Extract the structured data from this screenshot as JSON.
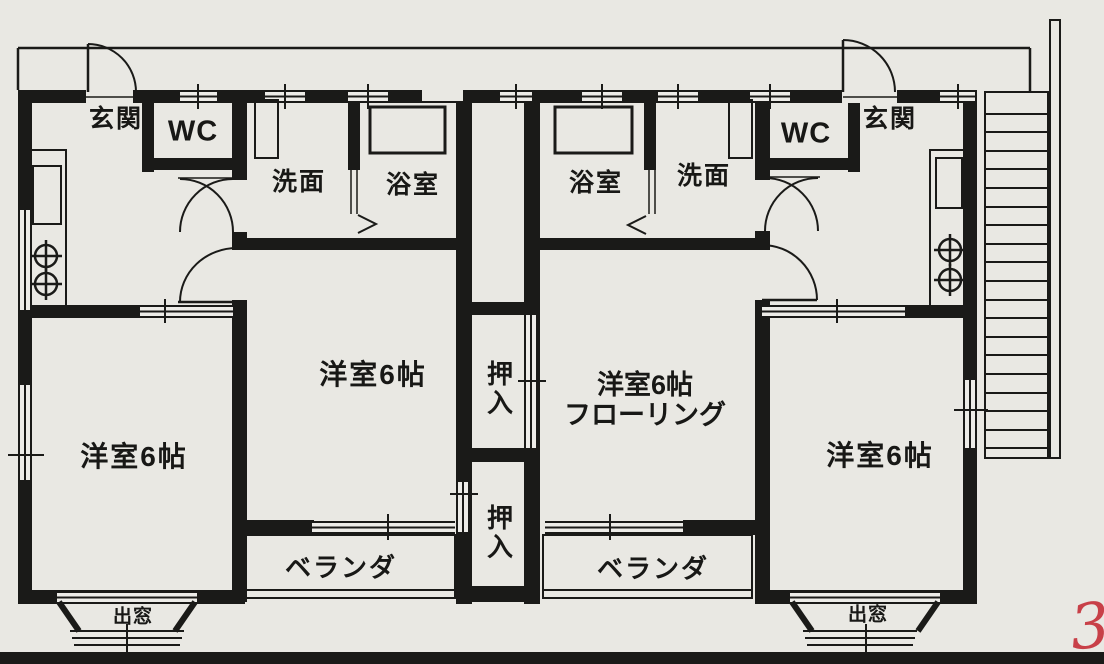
{
  "labels": {
    "genkan": "玄関",
    "wc": "WC",
    "senmen": "洗面",
    "yokushitsu": "浴室",
    "yoshitsu": "洋室6帖",
    "flooring": "フローリング",
    "oshiire": "押入",
    "veranda": "ベランダ",
    "demado": "出窓",
    "side_arrow": "<",
    "side_text": "入印保印",
    "red_mark": "3"
  },
  "colors": {
    "wall": "#1a1a18",
    "paper": "#e9e8e3",
    "red_pen": "#c84048"
  }
}
